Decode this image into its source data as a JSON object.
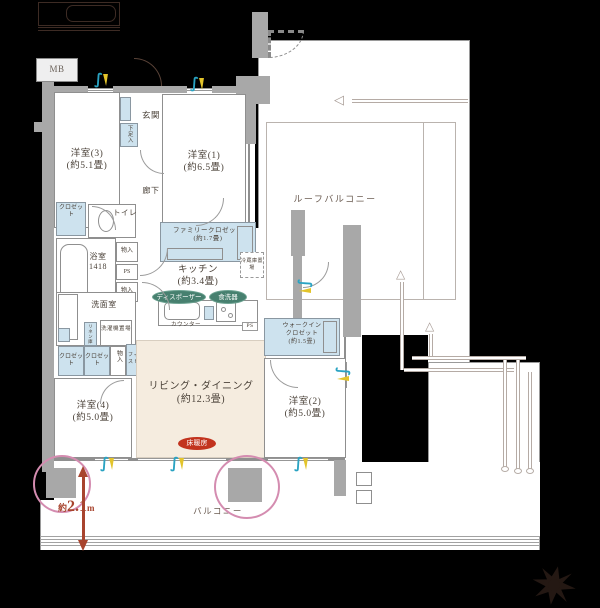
{
  "labels": {
    "mb": "MB"
  },
  "rooms": {
    "western3": {
      "name": "洋室(3)",
      "size": "(約5.1畳)"
    },
    "western1": {
      "name": "洋室(1)",
      "size": "(約6.5畳)"
    },
    "western2": {
      "name": "洋室(2)",
      "size": "(約5.0畳)"
    },
    "western4": {
      "name": "洋室(4)",
      "size": "(約5.0畳)"
    },
    "entrance": {
      "name": "玄関"
    },
    "shoe_box": {
      "name": "下足入"
    },
    "hallway": {
      "name": "廊下"
    },
    "toilet": {
      "name": "トイレ"
    },
    "bathroom": {
      "name": "浴室",
      "size": "1418"
    },
    "washroom": {
      "name": "洗面室"
    },
    "closet": {
      "name": "クロゼット"
    },
    "storage": {
      "name": "物入"
    },
    "pipe_space": {
      "name": "PS"
    },
    "linen": {
      "name": "リネン庫"
    },
    "laundry": {
      "name": "洗濯機置場"
    },
    "fit_storage": {
      "name": "フィットストレージ"
    },
    "family_closet": {
      "name": "ファミリークロゼット",
      "size": "(約1.7畳)"
    },
    "kitchen": {
      "name": "キッチン",
      "size": "(約3.4畳)"
    },
    "fridge": {
      "name": "冷蔵庫置場"
    },
    "counter": {
      "name": "カウンター"
    },
    "living_dining": {
      "name": "リビング・ダイニング",
      "size": "(約12.3畳)"
    },
    "walk_in_closet": {
      "line1": "ウォークイン",
      "line2": "クロゼット",
      "size": "(約1.5畳)"
    },
    "roof_balcony": {
      "name": "ルーフバルコニー"
    },
    "balcony": {
      "name": "バルコニー"
    }
  },
  "badges": {
    "disposer": "ディスポーザー",
    "dishwasher": "食洗器",
    "floor_heating": "床暖房"
  },
  "dimensions": {
    "balcony_depth_prefix": "約",
    "balcony_depth_value": "2.1",
    "balcony_depth_unit": "m"
  },
  "icons": {
    "vent_swirl": "∫",
    "drain_arrow_left": "◁",
    "drain_arrow_up": "△"
  },
  "colors": {
    "closet_fill": "#cde2ee",
    "living_fill": "#f5ecdf",
    "wall": "#a8a8a8",
    "badge_green": "#47806f",
    "floor_heating_red": "#c2331e",
    "dimension_red": "#a8442e",
    "pillar_highlight_pink": "#d48cb0",
    "vent_teal": "#2aa3c2",
    "vent_yellow": "#e3c42a"
  }
}
